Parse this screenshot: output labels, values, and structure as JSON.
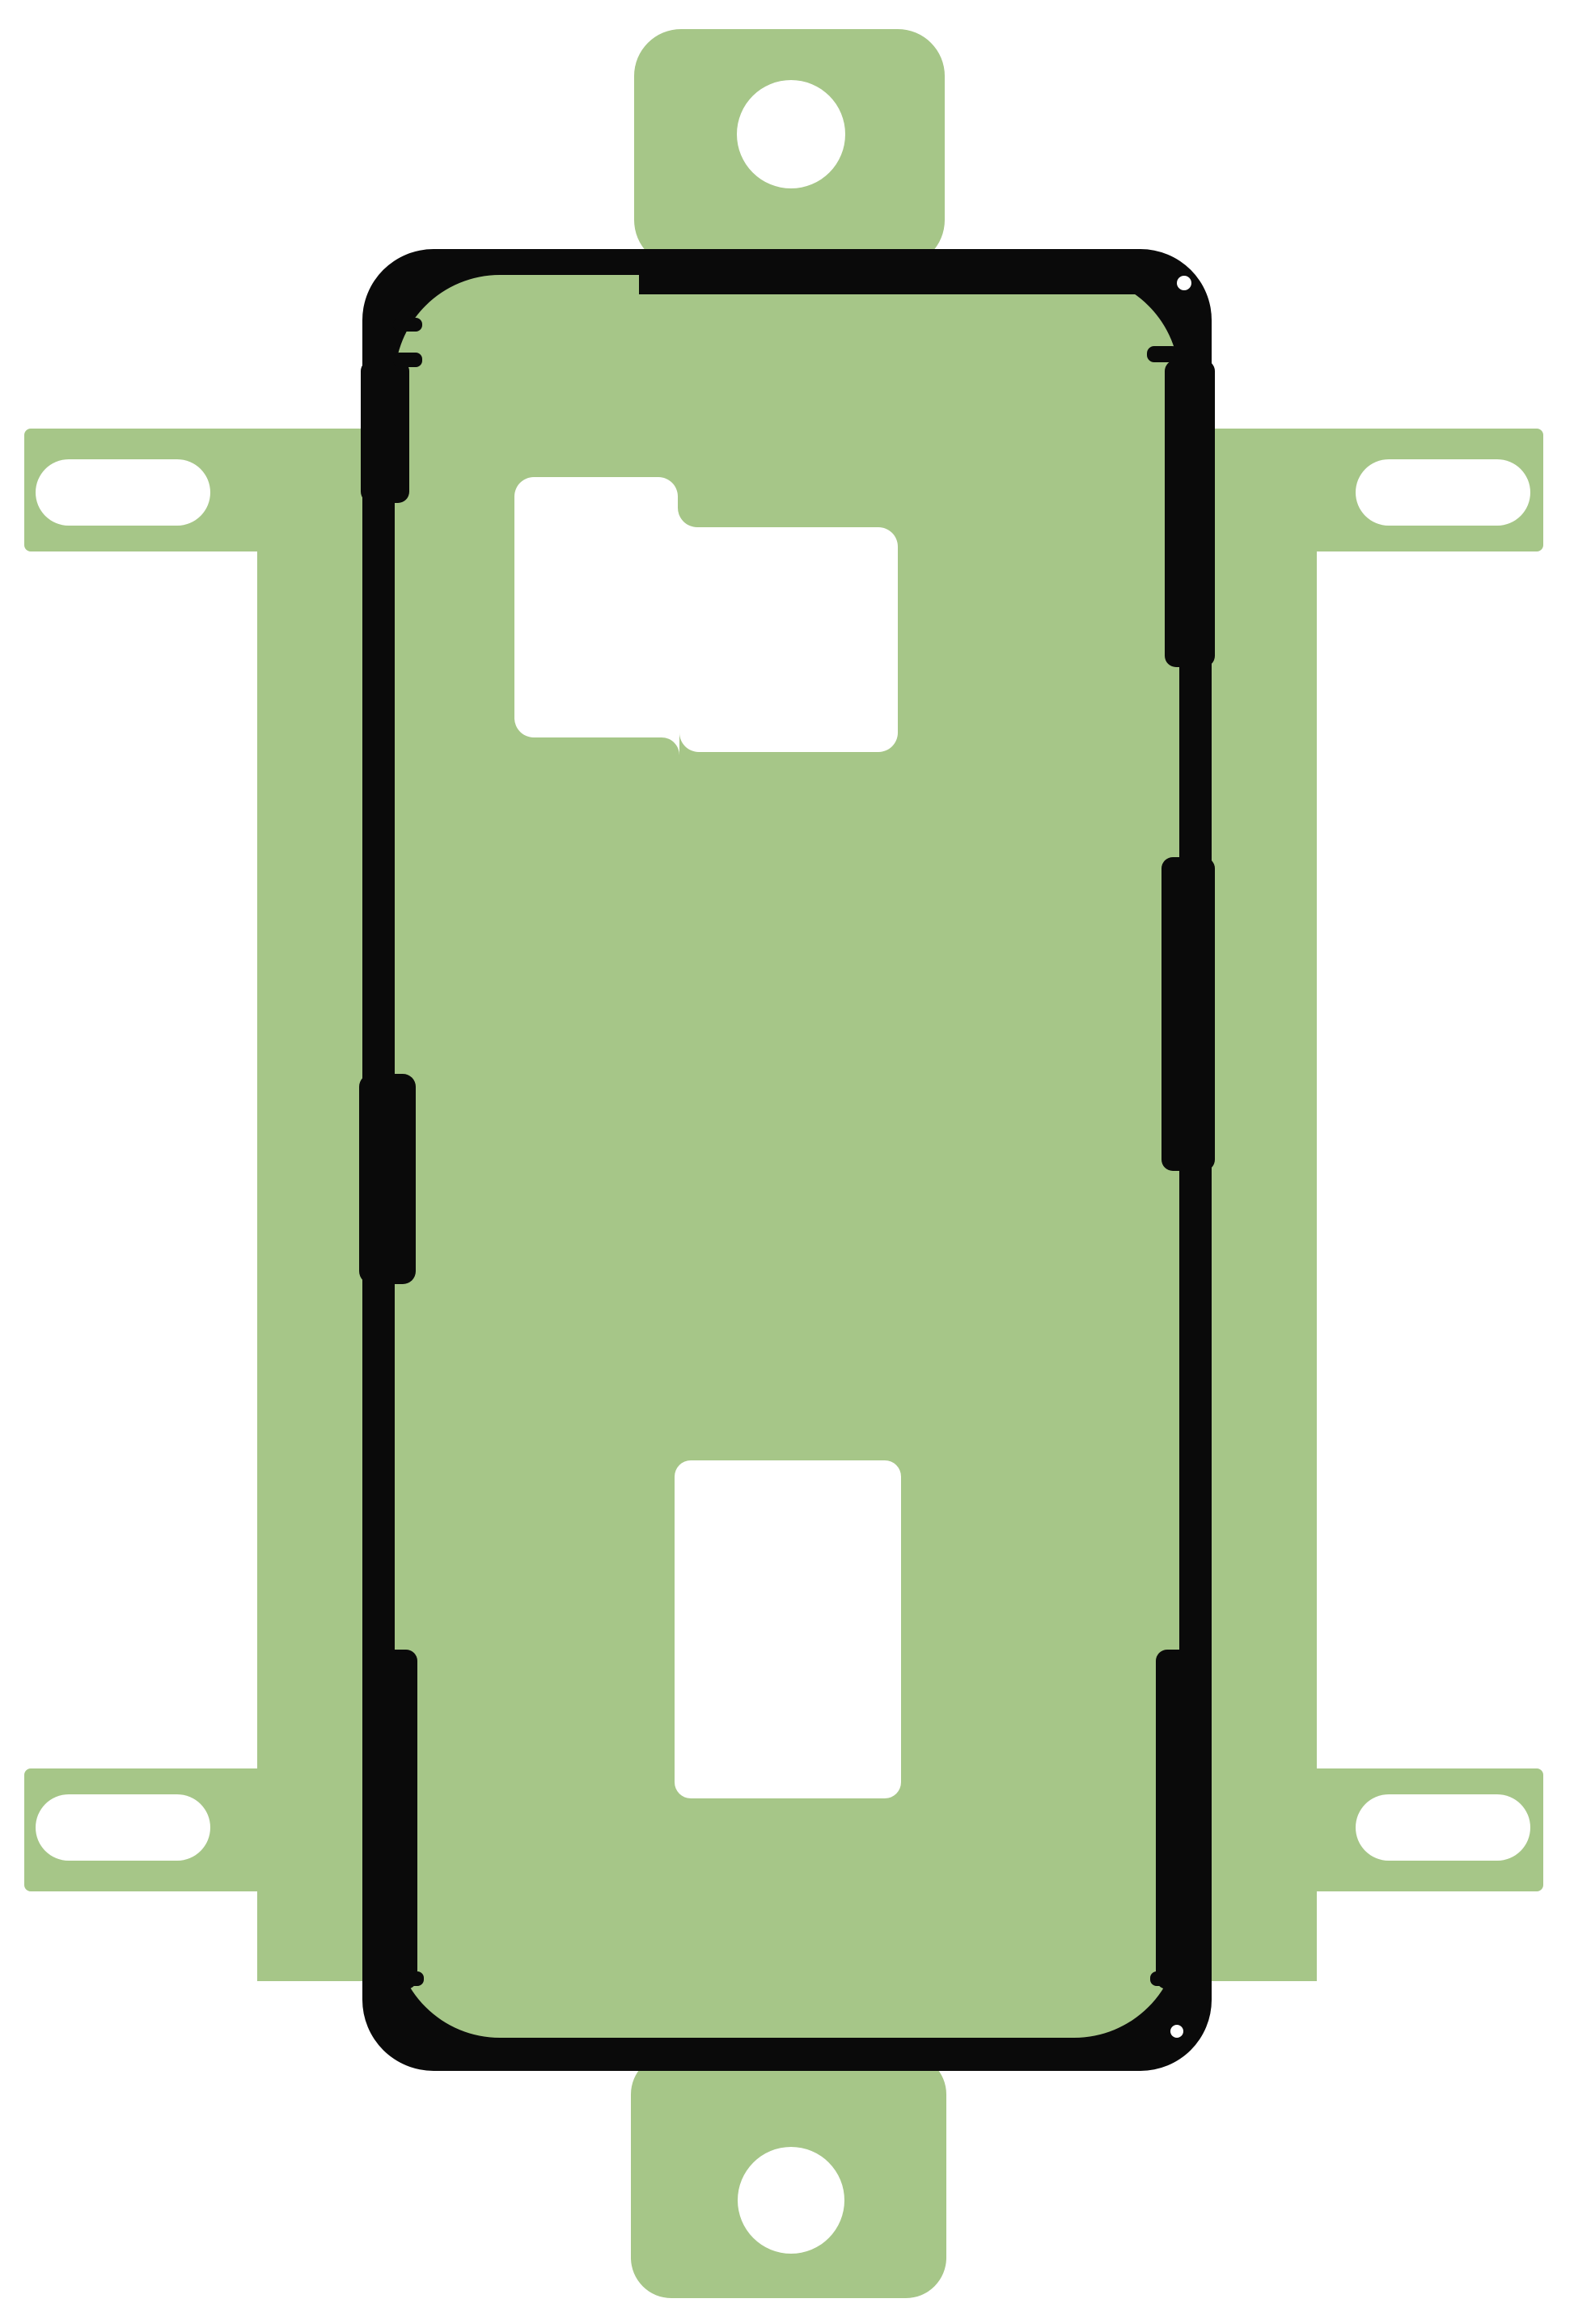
{
  "figure": {
    "type": "product-photo",
    "description": "Green adhesive sticker sheet (smartphone back-cover gasket) with black adhesive outline, alignment tabs with round holes, pill-shaped slots and white cutouts"
  },
  "colors": {
    "background": "#ffffff",
    "liner_green": "#a6c688",
    "adhesive_black": "#0a0a0a",
    "cutout_white": "#ffffff"
  },
  "counts": {
    "tab_holes": "2",
    "pill_slots": "4",
    "inner_cutouts": "2"
  }
}
